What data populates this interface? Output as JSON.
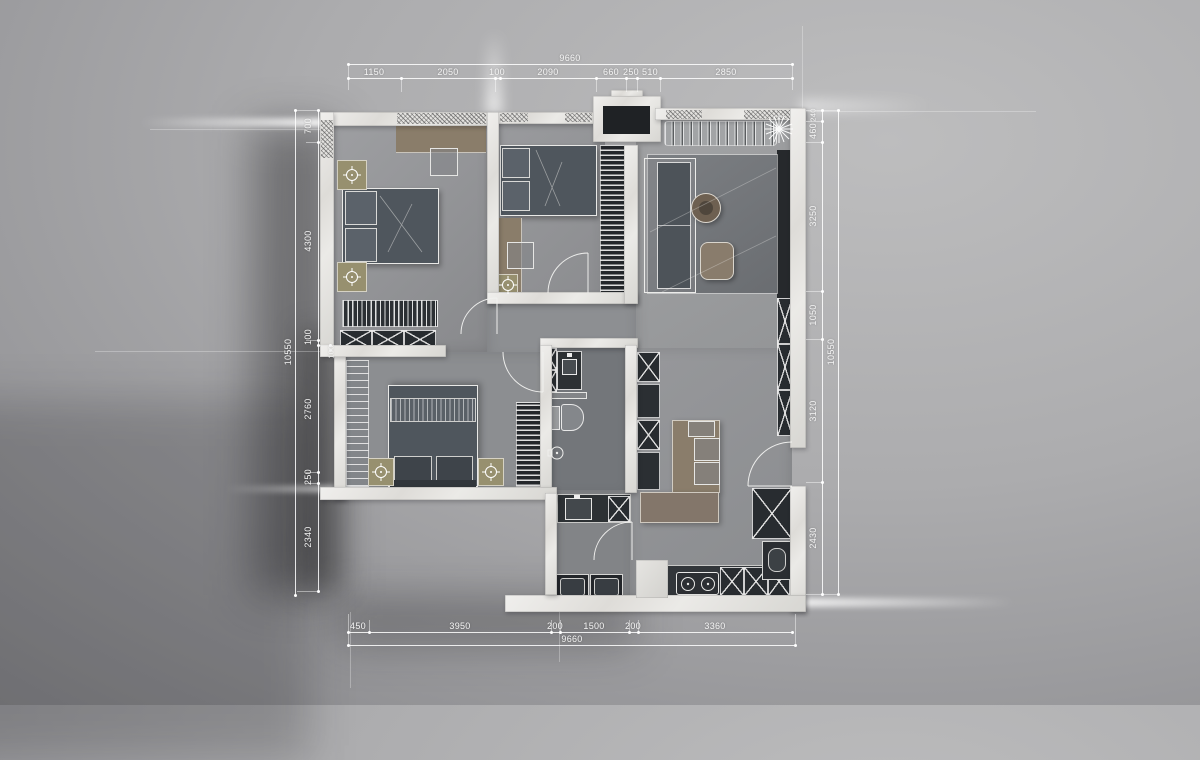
{
  "dims": {
    "top": {
      "overall": "9660",
      "segments": [
        "1150",
        "2050",
        "100",
        "2090",
        "660",
        "250",
        "510",
        "2850"
      ]
    },
    "bottom": {
      "overall": "9660",
      "segments": [
        "450",
        "3950",
        "200",
        "1500",
        "200",
        "3360"
      ]
    },
    "left": {
      "overall": "10550",
      "segments": [
        "700",
        "4300",
        "100",
        "100",
        "2760",
        "250",
        "2340"
      ]
    },
    "right": {
      "overall": "10550",
      "segments": [
        "240",
        "460",
        "3250",
        "1050",
        "3120",
        "2430"
      ]
    }
  },
  "colors": {
    "background": "#a3a3a5",
    "wall": "#e8e7e4",
    "floor": "#939598",
    "furniture_dark": "#3a3f44",
    "wood_brown": "#8a7d6a",
    "accent_tan": "#97906f",
    "dimension_line": "#ffffff"
  },
  "icons": {
    "lamp": "crosshair-lamp-icon",
    "plant": "plant-star-icon",
    "shower": "shower-head-icon",
    "cooktop": "two-burner-icon",
    "drain": "floor-drain-icon"
  }
}
